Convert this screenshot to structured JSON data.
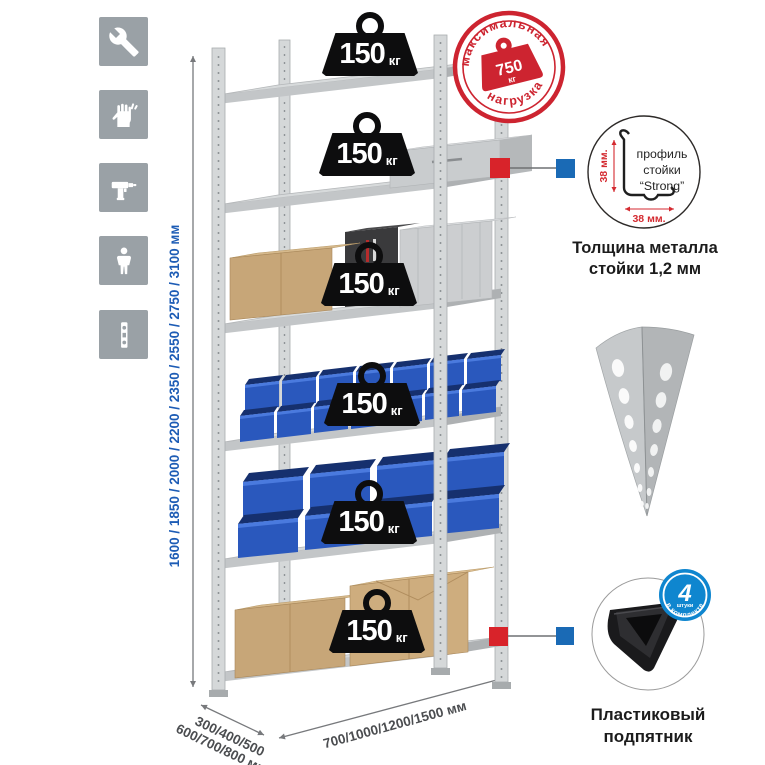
{
  "left_icons": [
    {
      "name": "wrench"
    },
    {
      "name": "gloves"
    },
    {
      "name": "drill"
    },
    {
      "name": "person"
    },
    {
      "name": "rack-post"
    }
  ],
  "dimensions": {
    "height": "1600 / 1850 / 2000 / 2200 / 2350 / 2550 / 2750 / 3100 мм",
    "depth_line1": "300/400/500",
    "depth_line2": "600/700/800 мм",
    "width": "700/1000/1200/1500 мм"
  },
  "shelf_load": {
    "value": "150",
    "unit": "кг",
    "shelves_count": 6
  },
  "stamp": {
    "arc_top": "максимальная",
    "arc_bottom": "нагрузка",
    "value": "750",
    "unit": "кг"
  },
  "profile_detail": {
    "line1": "профиль",
    "line2": "стойки",
    "line3": "“Strong”",
    "dim_vertical": "38 мм.",
    "dim_horizontal": "38 мм.",
    "caption_line1": "Толщина металла",
    "caption_line2": "стойки 1,2 мм"
  },
  "foot_detail": {
    "badge_number": "4",
    "badge_small": "штуки",
    "badge_arc": "в комплекте",
    "caption_line1": "Пластиковый",
    "caption_line2": "подпятник"
  },
  "colors": {
    "stamp_red": "#cd2430",
    "connector_red": "#d8232a",
    "connector_blue": "#1a6ab5",
    "dimension_blue": "#1d5cb5",
    "badge_blue": "#0f86cf",
    "bin_blue": "#2a58bd",
    "icon_gray": "#9aa1a6"
  }
}
